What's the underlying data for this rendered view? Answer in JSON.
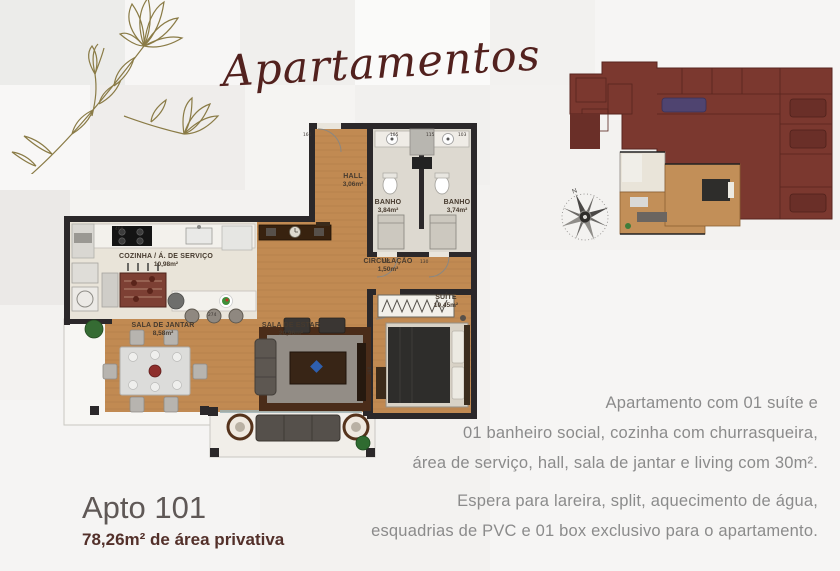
{
  "title": "Apartamentos",
  "unit": {
    "name": "Apto 101",
    "private_area": "78,26m² de área privativa"
  },
  "description": {
    "p1_lines": [
      "Apartamento com  01 suíte e",
      "01 banheiro social, cozinha com churrasqueira,",
      "área de serviço, hall, sala de jantar e living com 30m²."
    ],
    "p2_lines": [
      "Espera para lareira, split, aquecimento de água,",
      "esquadrias de PVC e 01 box exclusivo para o apartamento."
    ]
  },
  "plan": {
    "rooms": [
      {
        "name": "HALL",
        "area": "3,06m²"
      },
      {
        "name": "BANHO",
        "area": "3,84m²"
      },
      {
        "name": "BANHO",
        "area": "3,74m²"
      },
      {
        "name": "COZINHA / Á. DE SERVIÇO",
        "area": "10,98m²"
      },
      {
        "name": "CIRCULAÇÃO",
        "area": "1,50m²"
      },
      {
        "name": "SALA DE JANTAR",
        "area": "8,58m²"
      },
      {
        "name": "SALA DE ESTAR",
        "area": "20,96m²"
      },
      {
        "name": "SUÍTE",
        "area": "10,45m²"
      }
    ],
    "dimensions": {
      "d160": "160",
      "d105": "105",
      "d115": "115",
      "d103": "103",
      "d400": "400",
      "d274": "274",
      "d135": "135",
      "d130": "130",
      "d280": "280"
    }
  },
  "compass": {
    "north": "N"
  },
  "colors": {
    "accent_maroon": "#52211e",
    "siteplan_fill": "#7b382f",
    "wood": "#c18a52",
    "body_text": "#8b8b8b"
  }
}
